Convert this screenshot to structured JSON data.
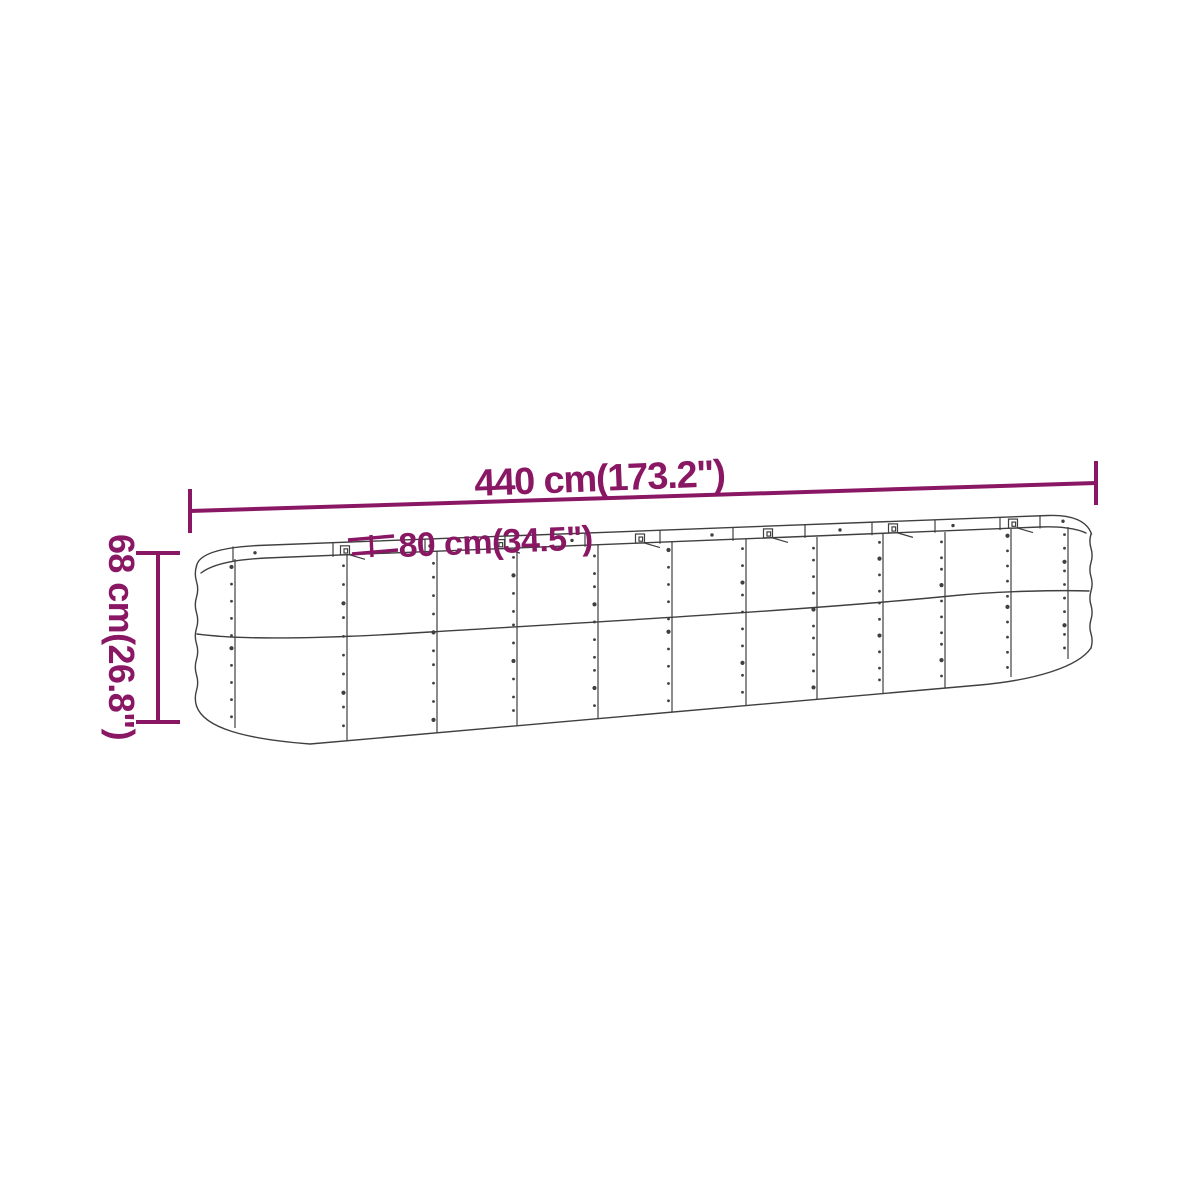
{
  "diagram": {
    "subject": "oval raised garden bed — perspective line drawing with dimension callouts",
    "background_color": "#ffffff",
    "accent_color": "#891763",
    "line_color": "#3f3f3f",
    "panel_count": 13,
    "dimensions": {
      "length": {
        "label": "440 cm(173.2\")",
        "cm": 440,
        "inches": 173.2
      },
      "width": {
        "label": "80 cm(34.5\")",
        "cm": 80,
        "inches": 34.5
      },
      "height": {
        "label": "68 cm(26.8\")",
        "cm": 68,
        "inches": 26.8
      }
    }
  }
}
